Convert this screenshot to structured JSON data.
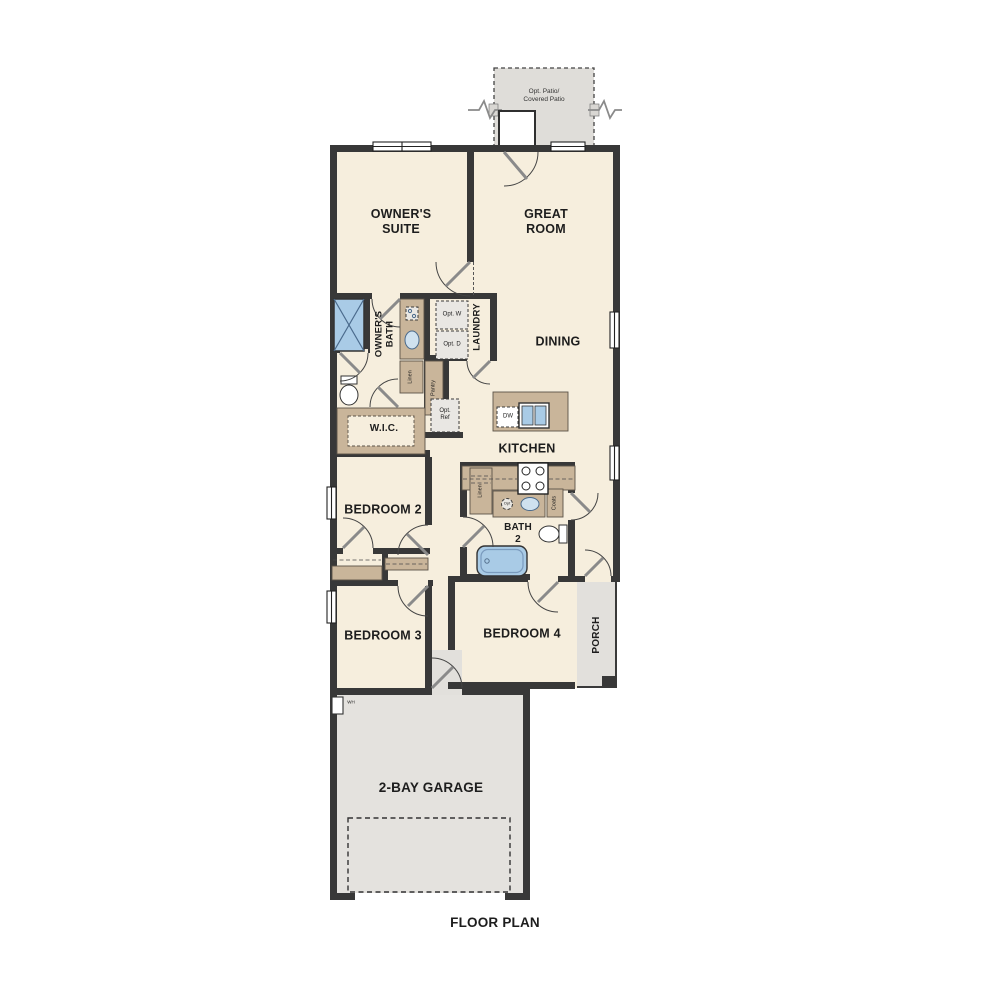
{
  "title": "FLOOR PLAN",
  "labels": {
    "opt_patio_1": "Opt. Patio/",
    "opt_patio_2": "Covered Patio",
    "owners_suite": "OWNER'S SUITE",
    "great_room": "GREAT ROOM",
    "dining": "DINING",
    "kitchen": "KITCHEN",
    "owners_bath": "OWNER'S BATH",
    "laundry": "LAUNDRY",
    "wic": "W.I.C.",
    "linen_bath": "Linen",
    "pantry": "Pantry",
    "opt_washer": "Opt. W",
    "opt_dryer": "Opt. D",
    "opt_ref": "Opt. Ref",
    "dishwasher": "DW",
    "bath2": "BATH 2",
    "linen_hall": "Linen",
    "coats": "Coats",
    "opt_circle": "Opt",
    "bedroom2": "BEDROOM 2",
    "bedroom3": "BEDROOM 3",
    "bedroom4": "BEDROOM 4",
    "porch": "PORCH",
    "water_heater": "WH",
    "garage": "2-BAY GARAGE"
  },
  "colors": {
    "floor": "#f6eedd",
    "hardscape": "#e2e0dc",
    "garage_floor": "#e4e2de",
    "wall": "#383838",
    "cabinet": "#c9b59a",
    "fixture_blue": "#a9cbe6",
    "optional_fill": "#e9e7e3",
    "text": "#1d1d1d"
  },
  "fixtures": [
    "shower-icon",
    "toilet-icon",
    "vanity-sink-icon",
    "kitchen-sink-icon",
    "dishwasher-icon",
    "range-icon",
    "bathtub-icon",
    "water-heater-icon",
    "door-swing-icon",
    "window-icon",
    "wall-break-icon"
  ]
}
